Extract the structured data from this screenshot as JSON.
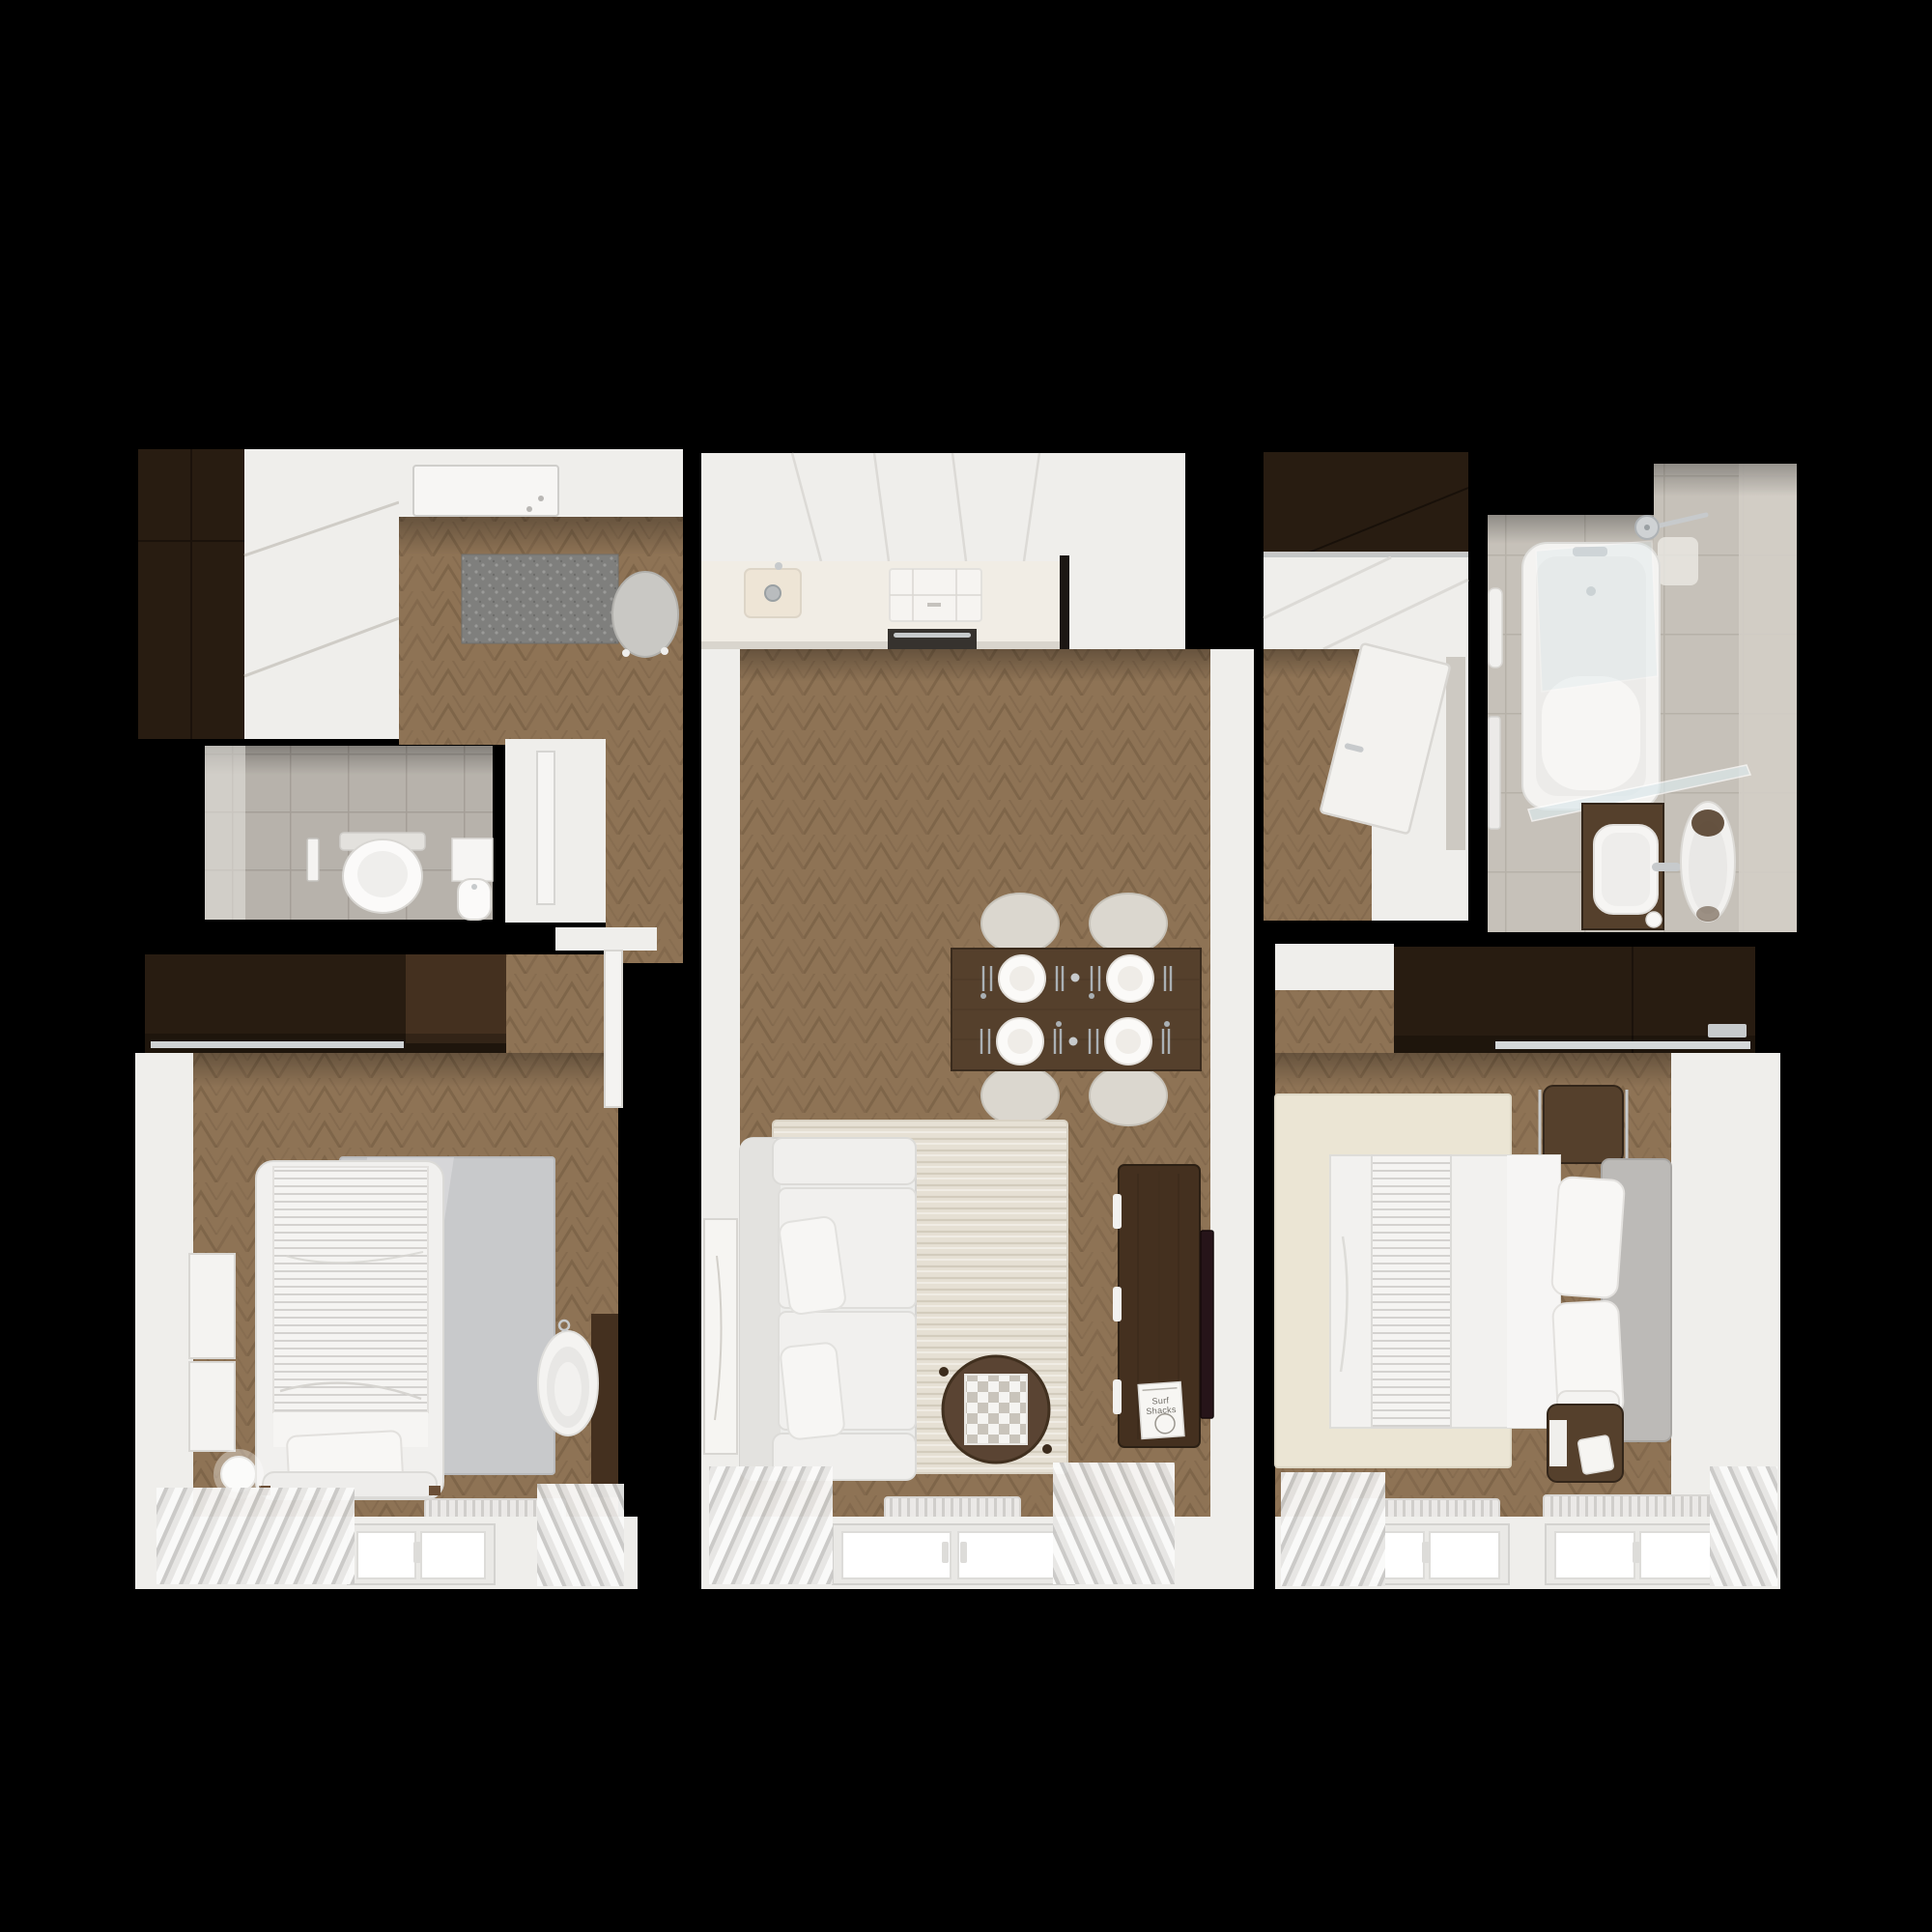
{
  "meta": {
    "kind": "apartment floor plan",
    "view": "top-down 3D render",
    "background": "#000000"
  },
  "palette": {
    "bg": "#000000",
    "wall": "#efeeeb",
    "wallShade": "#ddd9d4",
    "white": "#f5f4f2",
    "wood": "#8e7355",
    "woodLine": "#6e573e",
    "walnut": "#44301f",
    "walnutMid": "#55402c",
    "walnutDark": "#281c11",
    "tile": "#b7b2ab",
    "tileLine": "#a29d95",
    "tile2": "#c6c1b9",
    "tile2Line": "#b2ada4",
    "tileWall": "#d3cec7",
    "counter": "#f1ede5",
    "sinkCream": "#eee5d6",
    "mat": "#7f7f7d",
    "matDot": "#9a9a98",
    "rug": "#e6e0d4",
    "rugLine": "#cfc7b8",
    "rugSilver": "#c8c9cb",
    "rugCream": "#ebe5d4",
    "sofa": "#ededeb",
    "headboard": "#bcbab7",
    "curtain": "#e7e6e4",
    "curtainLine": "#c2c1be",
    "radiator": "#ebe9e7",
    "stripe": "#b5b3af",
    "chrome": "#c7cacc",
    "tv": "#261419",
    "lineSoft": "#d9d7d3",
    "glass": "#dce9ec"
  },
  "living_room": {
    "book_title": "Surf Shacks",
    "book_title_line1": "Surf",
    "book_title_line2": "Shacks"
  },
  "rooms": [
    {
      "id": "entry-hall",
      "name": "Entry hall",
      "furniture": [
        "tall dark wardrobe",
        "white sliding closet",
        "entrance door",
        "gray doormat",
        "stool"
      ]
    },
    {
      "id": "wc",
      "name": "Toilet room",
      "furniture": [
        "wall-hung toilet",
        "flush plate",
        "corner washbasin",
        "open door"
      ]
    },
    {
      "id": "corridor",
      "name": "Corridor",
      "furniture": [
        "open bedroom door"
      ]
    },
    {
      "id": "kitchen",
      "name": "Kitchen",
      "furniture": [
        "white cabinet run",
        "countertop",
        "sink",
        "induction cooktop",
        "oven"
      ]
    },
    {
      "id": "living-dining-room",
      "name": "Living / dining room",
      "furniture": [
        "dining table",
        "4 chairs",
        "4 place settings",
        "white sofa with pillows",
        "striped rug",
        "round coffee table with chessboard",
        "walnut TV sideboard",
        "book",
        "TV panel",
        "wall art",
        "radiator",
        "window",
        "sheer curtains"
      ]
    },
    {
      "id": "inner-hall",
      "name": "Inner hall",
      "furniture": [
        "overhead dark cabinet",
        "white sliding wardrobe",
        "open bathroom door"
      ]
    },
    {
      "id": "bathroom",
      "name": "Bathroom",
      "furniture": [
        "bathtub with glass screen",
        "rain shower head",
        "wood vanity with vessel sink",
        "oval mirror",
        "towel radiator",
        "wall cabinet"
      ]
    },
    {
      "id": "bedroom-1",
      "name": "Bedroom 1",
      "furniture": [
        "dark wardrobe with clothes rail",
        "bed with pinstriped duvet",
        "silver rug",
        "two wall frames",
        "ball floor lamp",
        "oval bassinet",
        "wood wall panel",
        "radiator",
        "window",
        "sheer curtains"
      ]
    },
    {
      "id": "bedroom-2",
      "name": "Bedroom 2",
      "furniture": [
        "dark wardrobe with clothes rail",
        "double bed with striped runner",
        "upholstered headboard",
        "two walnut nightstands",
        "alarm clock",
        "cream rug",
        "two radiators",
        "two windows",
        "sheer curtains"
      ]
    }
  ]
}
